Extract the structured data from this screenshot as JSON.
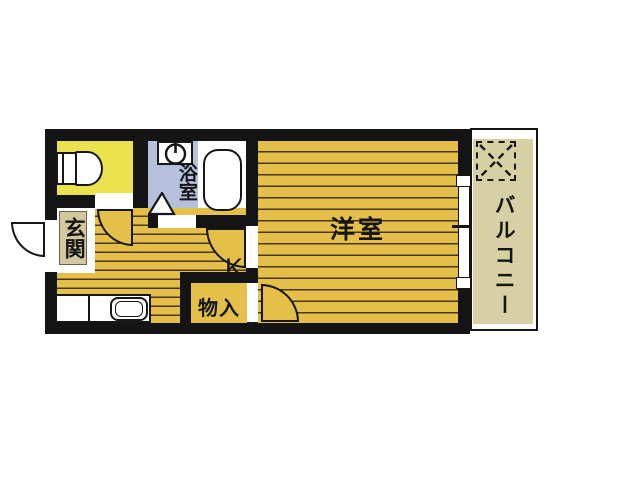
{
  "plan": {
    "type": "apartment-floorplan",
    "rooms": {
      "entrance": {
        "label": "玄関"
      },
      "bathroom": {
        "label": "浴室"
      },
      "kitchen": {
        "label": "K"
      },
      "storage": {
        "label": "物入"
      },
      "western_room": {
        "label": "洋室"
      },
      "balcony": {
        "label": "バルコニー"
      }
    },
    "fixtures": [
      "toilet",
      "bathtub",
      "washing-machine-place",
      "kitchen-sink",
      "hinged-door-swings",
      "entrance-door-swing",
      "balcony-hatch-square",
      "sliding-window"
    ],
    "colors": {
      "wall": "#141414",
      "floor": "#e4c04b",
      "floor_stripe": "#4a3508",
      "toilet_room": "#ebe24e",
      "bathroom_floor": "#b5c0dc",
      "entrance_mat": "#d2c79e",
      "balcony_floor": "#d6d0a4",
      "background": "#ffffff"
    }
  }
}
